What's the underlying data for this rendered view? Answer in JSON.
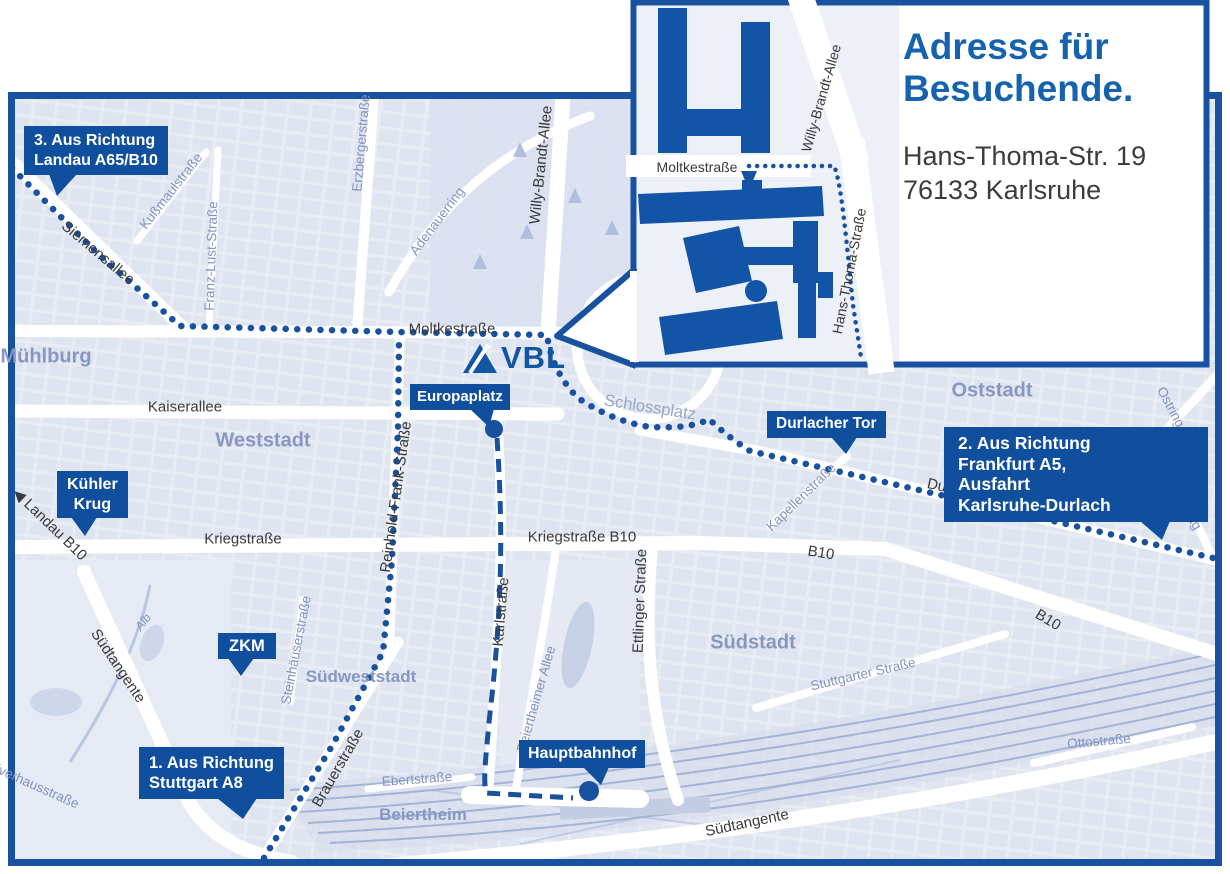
{
  "colors": {
    "brand_blue": "#0f4f9d",
    "route_blue": "#17519f",
    "building_blue": "#1254a5",
    "title_blue": "#1563ae",
    "map_bg": "#e9ecf3",
    "block_fill": "#dce2ef",
    "road_white": "#ffffff",
    "area_label": "#8897c2",
    "street_label": "#3a3a3a"
  },
  "logo": {
    "text": "VBL"
  },
  "inset": {
    "title": [
      "Adresse für",
      "Besuchende."
    ],
    "address": [
      "Hans-Thoma-Str. 19",
      "76133 Karlsruhe"
    ]
  },
  "callouts": {
    "route3": {
      "lines": [
        "3. Aus Richtung",
        "Landau A65/B10"
      ]
    },
    "kuehler_krug": {
      "lines": [
        "Kühler",
        "Krug"
      ]
    },
    "zkm": {
      "lines": [
        "ZKM"
      ]
    },
    "europaplatz": {
      "lines": [
        "Europaplatz"
      ]
    },
    "durlacher_tor": {
      "lines": [
        "Durlacher Tor"
      ]
    },
    "route2": {
      "lines": [
        "2. Aus Richtung",
        "Frankfurt A5,",
        "Ausfahrt",
        "Karlsruhe-Durlach"
      ]
    },
    "route1": {
      "lines": [
        "1. Aus Richtung",
        "Stuttgart A8"
      ]
    },
    "hauptbahnhof": {
      "lines": [
        "Hauptbahnhof"
      ]
    }
  },
  "map": {
    "labels": [
      {
        "t": "Siemensallee",
        "x": 98,
        "y": 253,
        "r": 40,
        "c": "street"
      },
      {
        "t": "Kußmaulstraße",
        "x": 171,
        "y": 191,
        "r": -52,
        "c": "bstreet"
      },
      {
        "t": "Franz-Lust-Straße",
        "x": 211,
        "y": 256,
        "r": -88,
        "c": "bstreet"
      },
      {
        "t": "Erzbergerstraße",
        "x": 361,
        "y": 143,
        "r": -85,
        "c": "bstreet"
      },
      {
        "t": "Adenauerring",
        "x": 437,
        "y": 221,
        "r": -53,
        "c": "bstreet"
      },
      {
        "t": "Willy-Brandt-Allee",
        "x": 541,
        "y": 165,
        "r": -84,
        "c": "street"
      },
      {
        "t": "Moltkestraße",
        "x": 452,
        "y": 329,
        "r": 0,
        "c": "street"
      },
      {
        "t": "Mühlburg",
        "x": 46,
        "y": 357,
        "r": 0,
        "c": "area"
      },
      {
        "t": "Kaiserallee",
        "x": 185,
        "y": 407,
        "r": 0,
        "c": "street"
      },
      {
        "t": "Weststadt",
        "x": 263,
        "y": 441,
        "r": 0,
        "c": "area"
      },
      {
        "t": "Schlossplatz",
        "x": 650,
        "y": 408,
        "r": 9,
        "c": "bstreet-lg"
      },
      {
        "t": "Oststadt",
        "x": 992,
        "y": 391,
        "r": 0,
        "c": "area"
      },
      {
        "t": "Durlacher Allee",
        "x": 977,
        "y": 494,
        "r": 12,
        "c": "street"
      },
      {
        "t": "Kapellenstraße",
        "x": 801,
        "y": 497,
        "r": -44,
        "c": "bstreet"
      },
      {
        "t": "Ostring",
        "x": 1171,
        "y": 407,
        "r": 62,
        "c": "bstreet"
      },
      {
        "t": "Ostring",
        "x": 1187,
        "y": 510,
        "r": 58,
        "c": "bstreet"
      },
      {
        "t": "◀ Landau B10",
        "x": 50,
        "y": 524,
        "r": 44,
        "c": "street"
      },
      {
        "t": "Kriegstraße",
        "x": 243,
        "y": 539,
        "r": 0,
        "c": "street"
      },
      {
        "t": "Kriegstraße B10",
        "x": 582,
        "y": 537,
        "r": 0,
        "c": "street"
      },
      {
        "t": "B10",
        "x": 821,
        "y": 553,
        "r": 9,
        "c": "street"
      },
      {
        "t": "B10",
        "x": 1048,
        "y": 620,
        "r": 31,
        "c": "street"
      },
      {
        "t": "Reinhold-Frank-Straße",
        "x": 396,
        "y": 497,
        "r": -82,
        "c": "street"
      },
      {
        "t": "Karlstraße",
        "x": 501,
        "y": 612,
        "r": -85,
        "c": "street"
      },
      {
        "t": "Ettlinger Straße",
        "x": 640,
        "y": 601,
        "r": -88,
        "c": "street"
      },
      {
        "t": "Südstadt",
        "x": 753,
        "y": 643,
        "r": 0,
        "c": "area"
      },
      {
        "t": "Stuttgarter Straße",
        "x": 863,
        "y": 674,
        "r": -13,
        "c": "bstreet"
      },
      {
        "t": "Steinhäuserstraße",
        "x": 296,
        "y": 650,
        "r": -79,
        "c": "bstreet"
      },
      {
        "t": "Südweststadt",
        "x": 361,
        "y": 677,
        "r": 0,
        "c": "area-sm"
      },
      {
        "t": "Alb",
        "x": 143,
        "y": 622,
        "r": -52,
        "c": "bstreet-i"
      },
      {
        "t": "Südtangente",
        "x": 118,
        "y": 666,
        "r": 56,
        "c": "street"
      },
      {
        "t": "Pulverhausstraße",
        "x": 30,
        "y": 783,
        "r": 24,
        "c": "bstreet"
      },
      {
        "t": "Beiertheimer Allee",
        "x": 536,
        "y": 699,
        "r": -74,
        "c": "bstreet"
      },
      {
        "t": "Brauerstraße",
        "x": 338,
        "y": 768,
        "r": -60,
        "c": "street"
      },
      {
        "t": "Ebertstraße",
        "x": 417,
        "y": 779,
        "r": -4,
        "c": "bstreet"
      },
      {
        "t": "Beiertheim",
        "x": 423,
        "y": 815,
        "r": 0,
        "c": "area-sm"
      },
      {
        "t": "Südtangente",
        "x": 747,
        "y": 823,
        "r": -12,
        "c": "street"
      },
      {
        "t": "Ottostraße",
        "x": 1099,
        "y": 741,
        "r": -5,
        "c": "bstreet"
      },
      {
        "t": "Moltkestraße",
        "x": 697,
        "y": 167,
        "r": 0,
        "c": "street-ins"
      },
      {
        "t": "Willy-Brandt-Allee",
        "x": 821,
        "y": 98,
        "r": -74,
        "c": "street-ins"
      },
      {
        "t": "Hans-Thoma-Straße",
        "x": 849,
        "y": 271,
        "r": -79,
        "c": "street-ins"
      }
    ]
  }
}
